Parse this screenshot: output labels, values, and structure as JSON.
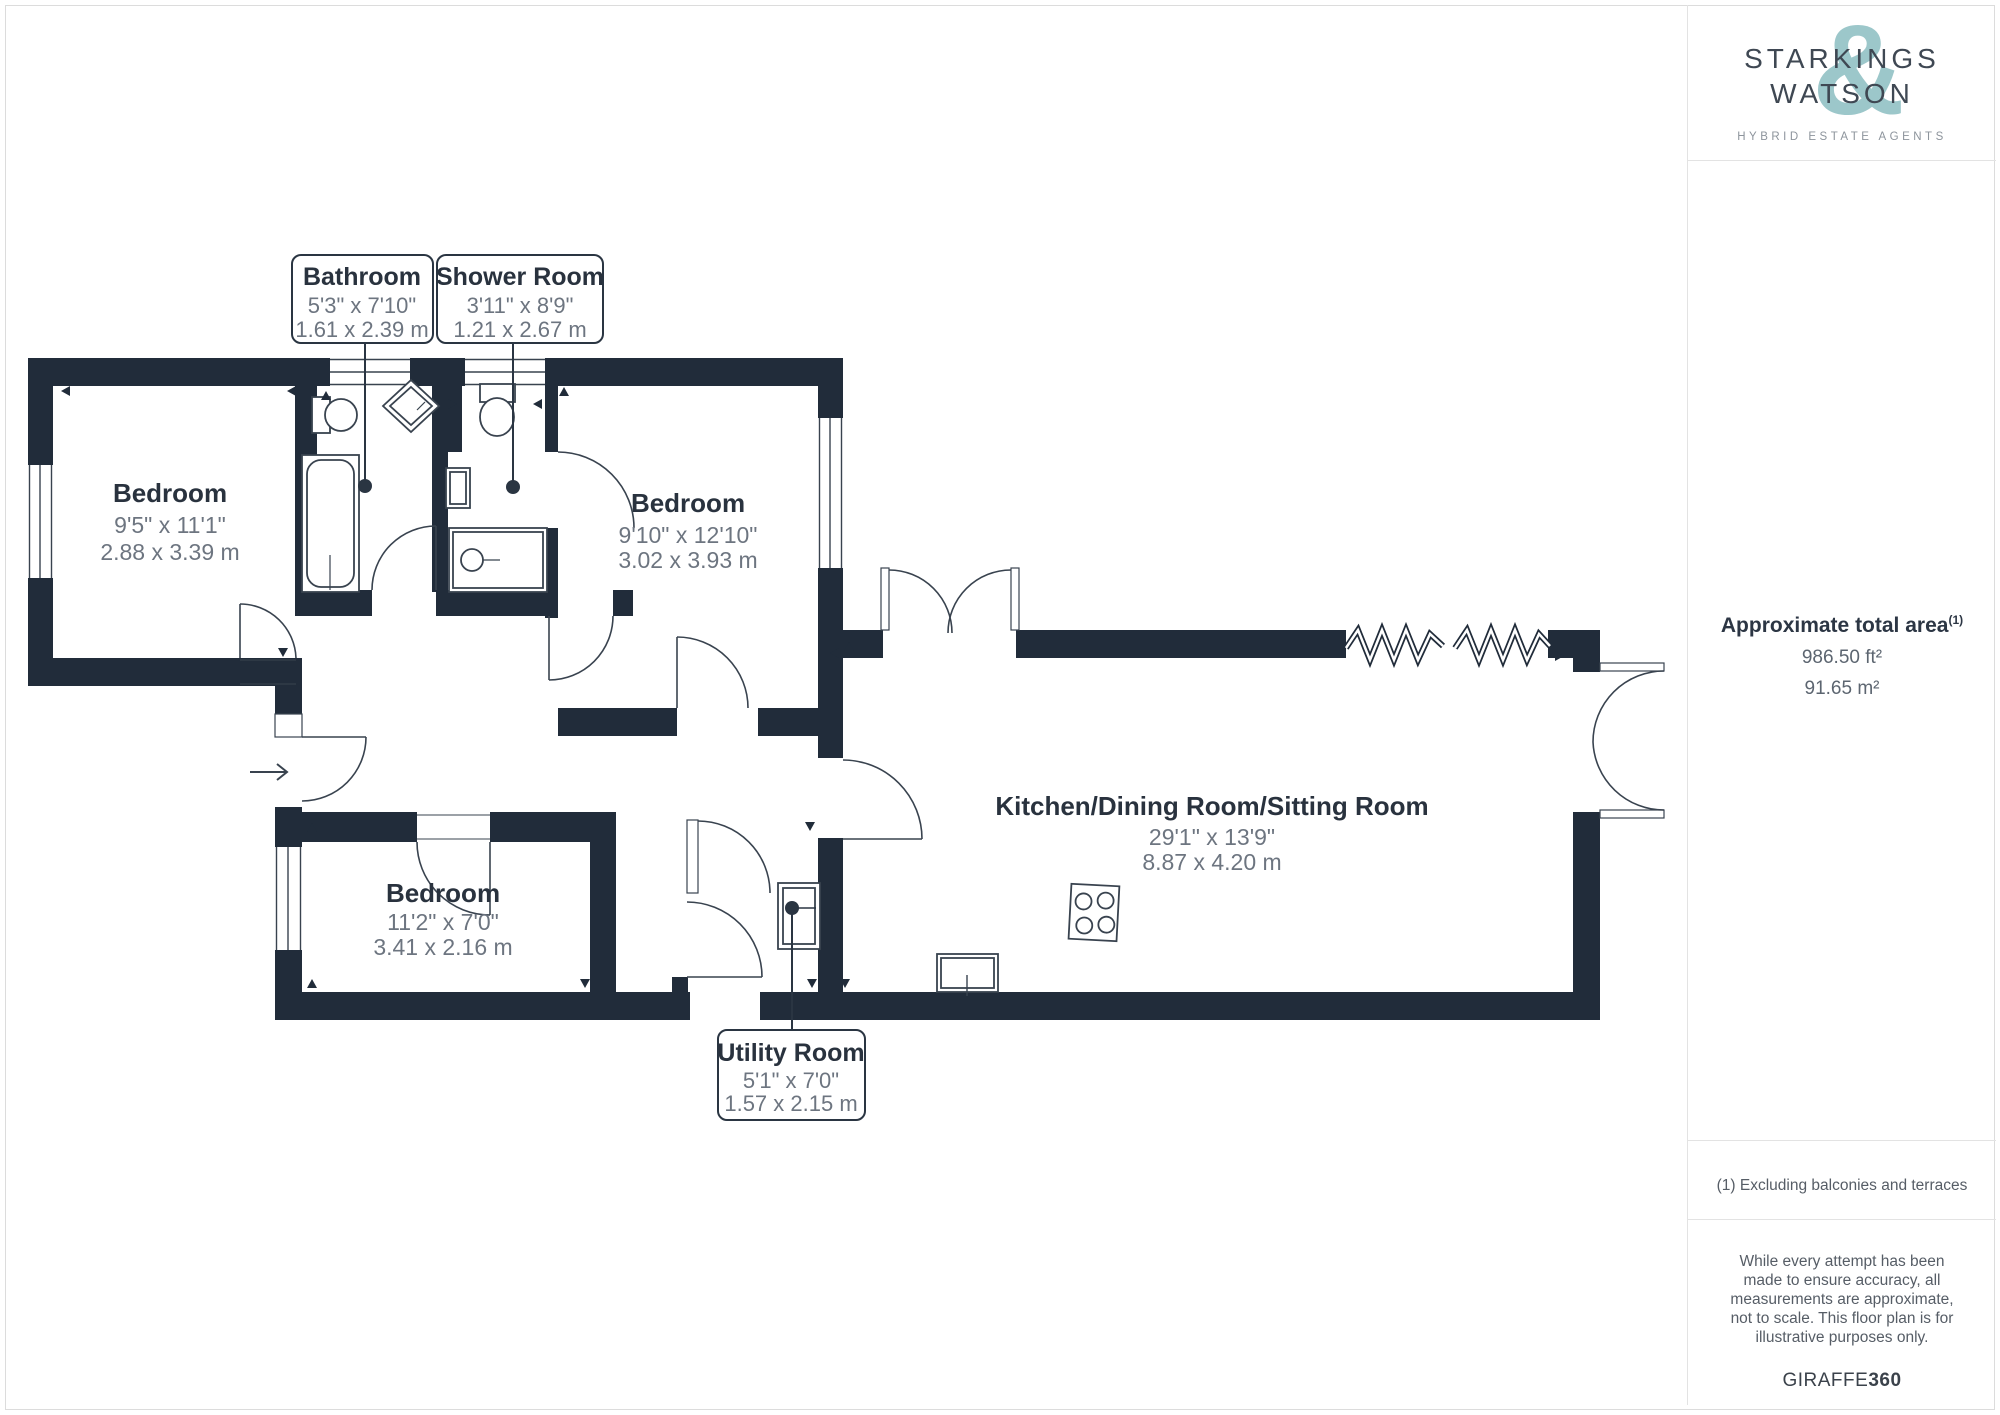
{
  "floorplan": {
    "rooms": [
      {
        "name": "Bathroom",
        "dims_ft": "5'3\" x 7'10\"",
        "dims_m": "1.61 x 2.39 m"
      },
      {
        "name": "Shower Room",
        "dims_ft": "3'11\" x 8'9\"",
        "dims_m": "1.21 x 2.67 m"
      },
      {
        "name": "Bedroom",
        "dims_ft": "9'5\" x 11'1\"",
        "dims_m": "2.88 x 3.39 m"
      },
      {
        "name": "Bedroom",
        "dims_ft": "9'10\" x 12'10\"",
        "dims_m": "3.02 x 3.93 m"
      },
      {
        "name": "Bedroom",
        "dims_ft": "11'2\" x 7'0\"",
        "dims_m": "3.41 x 2.16 m"
      },
      {
        "name": "Kitchen/Dining Room/Sitting Room",
        "dims_ft": "29'1\" x 13'9\"",
        "dims_m": "8.87 x 4.20 m"
      },
      {
        "name": "Utility Room",
        "dims_ft": "5'1\" x 7'0\"",
        "dims_m": "1.57 x 2.15 m"
      }
    ]
  },
  "sidebar": {
    "brand": {
      "line1": "STARKINGS",
      "line2": "WATSON",
      "ampersand": "&",
      "tagline": "HYBRID ESTATE AGENTS"
    },
    "area": {
      "title": "Approximate total area",
      "superscript": "(1)",
      "ft": "986.50 ft²",
      "m": "91.65 m²"
    },
    "footnote": "(1) Excluding balconies and terraces",
    "disclaimer": "While every attempt has been made to ensure accuracy, all measurements are approximate, not to scale. This floor plan is for illustrative purposes only.",
    "credit": {
      "name": "GIRAFFE",
      "suffix": "360"
    }
  },
  "colors": {
    "wall": "#212c3a",
    "accent": "#9cc7ca",
    "line": "#39434f"
  }
}
